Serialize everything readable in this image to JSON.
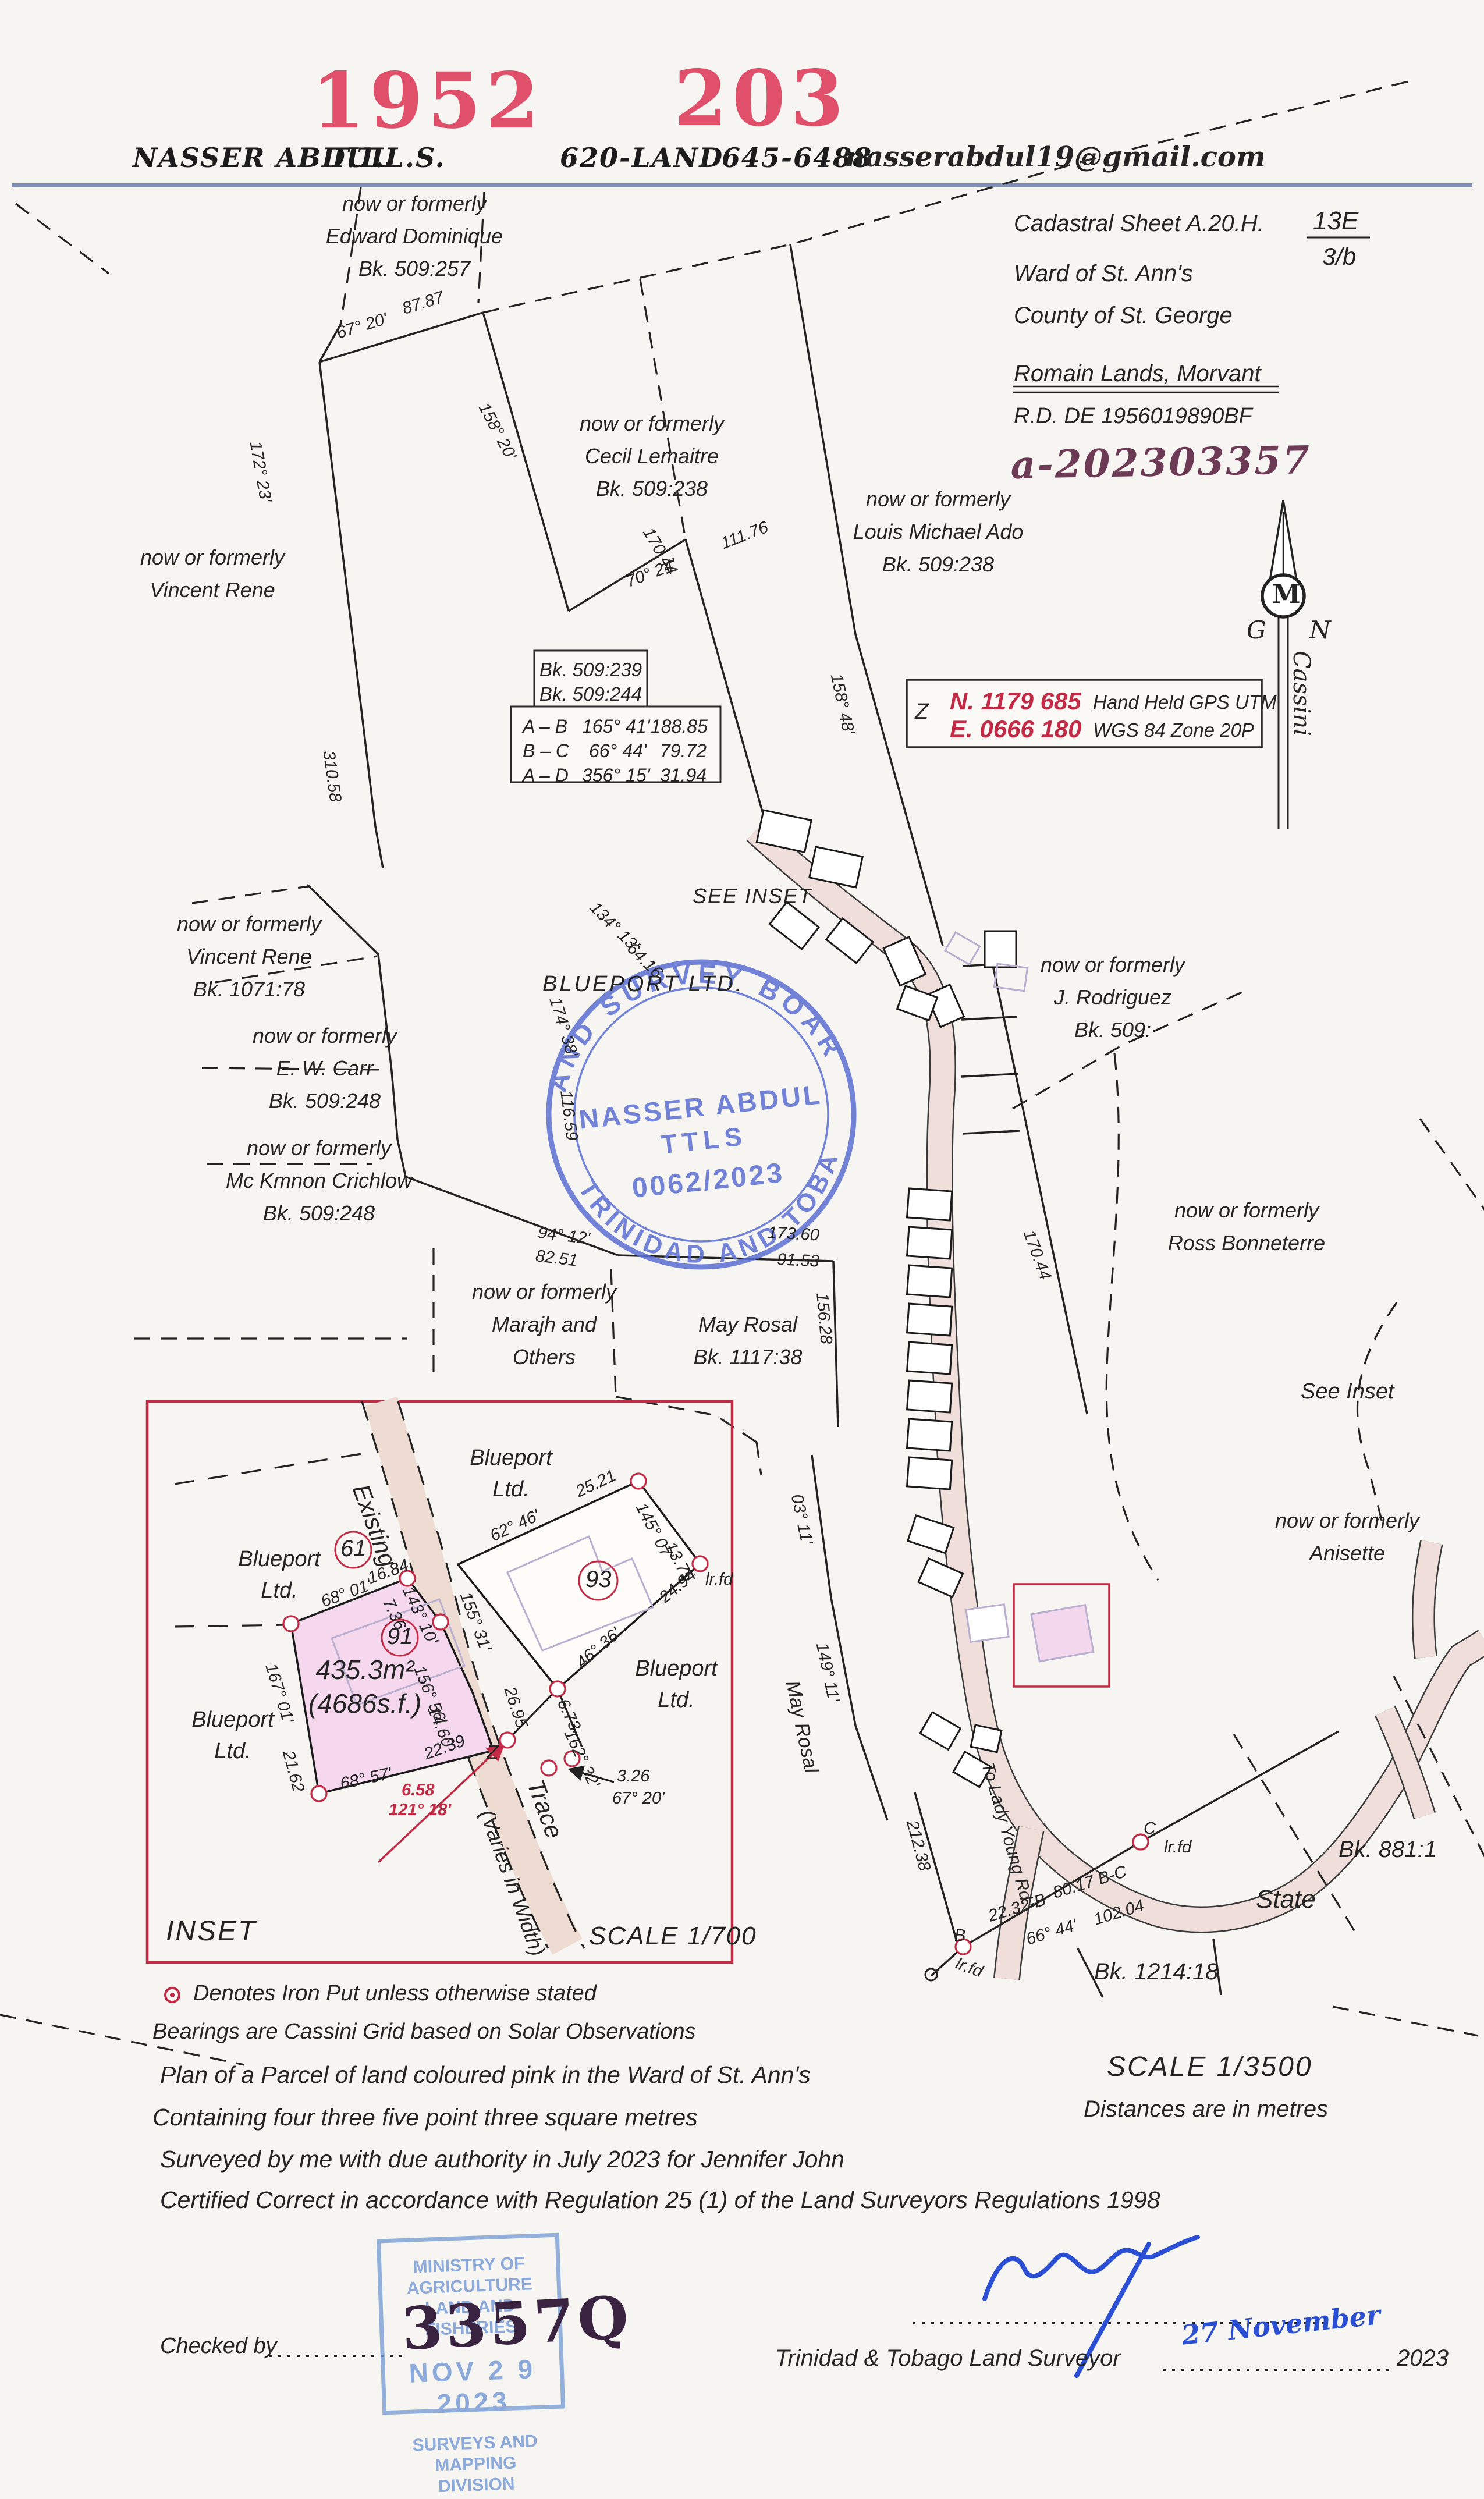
{
  "colors": {
    "red_accent": "#e0506b",
    "crimson": "#c22a45",
    "stamp_blue": "#5b6ed3",
    "ministry_blue": "#8ba9da",
    "signature_blue": "#2b4fd4",
    "handwritten_purple": "#6d3a56",
    "road_tan": "#efdeda",
    "parcel_pink": "#f5d8ee",
    "rule_blue": "#7f8fb5"
  },
  "header": {
    "ref_left": "1952",
    "ref_right": "203",
    "name": "NASSER ABDUL",
    "title": "T.T.L.S.",
    "phone_label": "620-LAND",
    "phone": "645-6488",
    "email": "nasserabdul19@gmail.com"
  },
  "title_block": {
    "cadastral": "Cadastral Sheet A.20.H.",
    "sheet_no": "13E",
    "sheet_sub": "3/b",
    "ward": "Ward of St. Ann's",
    "county": "County of St. George",
    "locality": "Romain Lands, Morvant",
    "deed": "R.D. DE 1956019890BF",
    "plan_ref": "a-202303357"
  },
  "north_arrow": {
    "monogram": "M",
    "left": "G",
    "right": "N",
    "grid": "Cassini"
  },
  "gps_box": {
    "point": "Z",
    "northing": "N. 1179 685",
    "easting": "E. 0666 180",
    "method": "Hand Held GPS UTM",
    "datum": "WGS 84 Zone 20P"
  },
  "bearing_box": {
    "book1": "Bk. 509:239",
    "book2": "Bk. 509:244",
    "rows": [
      {
        "leg": "A – B",
        "bearing": "165° 41'",
        "distance": "188.85"
      },
      {
        "leg": "B – C",
        "bearing": "66° 44'",
        "distance": "79.72"
      },
      {
        "leg": "A – D",
        "bearing": "356° 15'",
        "distance": "31.94"
      }
    ]
  },
  "stamp": {
    "arc_top": "LAND SURVEY BOARD",
    "arc_bottom": "OF TRINIDAD AND TOBAGO",
    "name": "NASSER ABDUL",
    "title": "TTLS",
    "number": "0062/2023"
  },
  "ministry_stamp": {
    "line1": "MINISTRY OF AGRICULTURE",
    "line2": "LAND AND FISHERIES",
    "date": "NOV 2 9 2023",
    "line3": "SURVEYS AND MAPPING",
    "line4": "DIVISION",
    "handwritten": "3357Q"
  },
  "adjoiners": {
    "edward": {
      "l1": "now or formerly",
      "l2": "Edward Dominique",
      "l3": "Bk. 509:257"
    },
    "cecil": {
      "l1": "now or formerly",
      "l2": "Cecil Lemaitre",
      "l3": "Bk. 509:238"
    },
    "louis": {
      "l1": "now or formerly",
      "l2": "Louis Michael Ado",
      "l3": "Bk. 509:238"
    },
    "vincent_top": {
      "l1": "now or formerly",
      "l2": "Vincent Rene"
    },
    "vincent": {
      "l1": "now or formerly",
      "l2": "Vincent Rene",
      "l3": "Bk. 1071:78"
    },
    "carr": {
      "l1": "now or formerly",
      "l2": "E. W. Carr",
      "l3": "Bk. 509:248"
    },
    "crichlow": {
      "l1": "now or formerly",
      "l2": "Mc Kmnon Crichlow",
      "l3": "Bk. 509:248"
    },
    "marajh": {
      "l1": "now or formerly",
      "l2": "Marajh and",
      "l3": "Others"
    },
    "may_rosal": {
      "l1": "May Rosal",
      "l2": "Bk. 1117:38"
    },
    "rodriguez": {
      "l1": "now or formerly",
      "l2": "J. Rodriguez",
      "l3": "Bk. 509:"
    },
    "ross": {
      "l1": "now or formerly",
      "l2": "Ross Bonneterre"
    },
    "anisette": {
      "l1": "now or formerly",
      "l2": "Anisette"
    },
    "state": "State",
    "bk881": "Bk. 881:1",
    "bk1214": "Bk. 1214:18",
    "blueport_main": "BLUEPORT  LTD.",
    "see_inset_caps": "SEE INSET",
    "see_inset": "See Inset"
  },
  "roads": {
    "to_lady_young": "To Lady Young Rd.",
    "may_rosal": "May Rosal",
    "existing": "Existing",
    "trace": "Trace",
    "varies": "(Varies in Width)"
  },
  "dims": {
    "d67_20": "67° 20'",
    "d87": "87.87",
    "d158_20": "158° 20'",
    "d172_23": "172° 23'",
    "d310": "310.58",
    "d170_44a": "170.44",
    "d70_24": "70° 24'",
    "d111": "111.76",
    "d158_48": "158° 48'",
    "d134": "134° 13'",
    "d64": "64.16",
    "d174_38": "174° 38'",
    "d116": "116.59",
    "d94_12": "94° 12'",
    "d82": "82.51",
    "d173": "173.60",
    "d91_5": "91.53",
    "d156_28": "156.28",
    "d03_11": "03° 11'",
    "d149_11": "149° 11'",
    "d170_44b": "170.44",
    "d212": "212.38",
    "d22_32": "22.32-B",
    "d80_17": "80.17 B-C",
    "d66_44": "66° 44'",
    "d102": "102.04",
    "lrfd": "lr.fd",
    "ptB": "B",
    "ptC": "C",
    "ptZ": "Z"
  },
  "inset": {
    "title": "INSET",
    "scale": "SCALE 1/700",
    "area_m": "435.3m²",
    "area_f": "(4686s.f.)",
    "lot61": "61",
    "lot91": "91",
    "lot93": "93",
    "blueport": "Blueport",
    "ltd": "Ltd.",
    "d68_01": "68° 01'",
    "d16_84": "16.84",
    "d143_10": "143° 10'",
    "d7_36": "7.36",
    "d167_01": "167° 01'",
    "d21_62": "21.62",
    "d68_57": "68° 57'",
    "d156_56": "156° 56'",
    "d14_60": "14.60",
    "d22_39": "22.39",
    "d62_46": "62° 46'",
    "d25_21": "25.21",
    "d145_07": "145° 07'",
    "d13_75": "13.75",
    "d24_94": "24.94",
    "d46_36": "46° 36'",
    "d26_95": "26.95",
    "d155_31": "155° 31'",
    "d6_73": "6.73",
    "d162_32": "162° 32'",
    "d3_26": "3.26",
    "d67_20": "67° 20'",
    "red_dist": "6.58",
    "red_brg": "121° 18'",
    "lrfd": "lr.fd",
    "ptZ": "Z"
  },
  "notes": {
    "legend": "Denotes Iron Put unless otherwise stated",
    "bearings": "Bearings are Cassini Grid based on Solar Observations",
    "plan": "Plan of a Parcel of land coloured pink in the Ward of St. Ann's",
    "containing": "Containing four three five point three square metres",
    "surveyed": "Surveyed by me with due authority in July 2023 for Jennifer John",
    "certified": "Certified Correct in accordance with Regulation 25 (1) of the Land Surveyors Regulations 1998",
    "scale": "SCALE 1/3500",
    "distances": "Distances are in metres",
    "checked": "Checked by",
    "surveyor_line": "Trinidad & Tobago Land Surveyor",
    "year": "2023",
    "sig_date": "27 November"
  }
}
